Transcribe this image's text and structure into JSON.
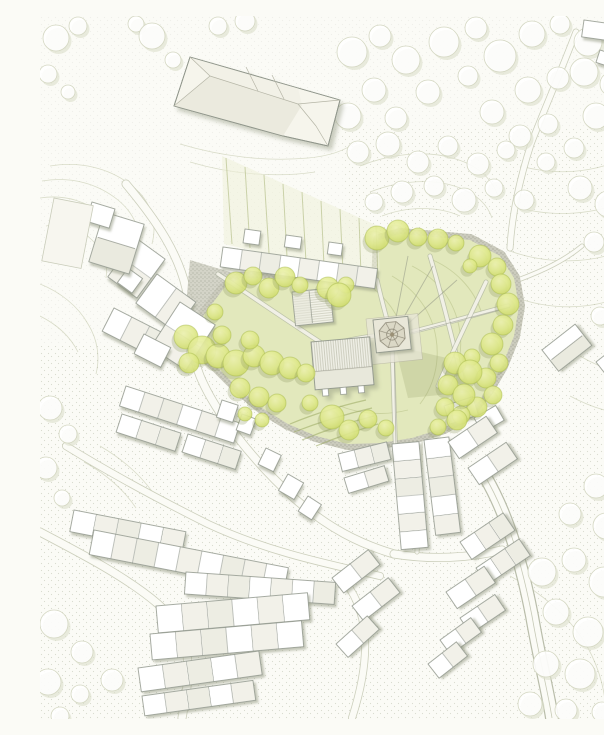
{
  "figure": {
    "kind": "architectural-site-plan",
    "width": 604,
    "height": 703
  },
  "palette": {
    "background": "#fbfbf6",
    "contour": "#b7bd9b",
    "lawnLine": "#b2bc80",
    "parkFill": "#e2e8bc",
    "treeGradIn": "#eef3b0",
    "treeGradMid": "#dfe98a",
    "treeGradOut": "#ccd964",
    "treeEdge": "#aabc4e",
    "treeShadow": "#8d9861",
    "faintTreeStroke": "#d4d7c2",
    "faintTreeShadow": "#dcdfcc",
    "buildingFill": "#ffffff",
    "buildingTint": "#efeee3",
    "buildingTint2": "#e9e8dc",
    "buildingStroke": "#90968b",
    "bandBase": "#cbcbbd",
    "dotInk": "#6f7463",
    "grainInk": "#9aa088",
    "streetEdge": "#cccfbc",
    "pathFill": "#f1f0e6",
    "pathEdge": "#aab09e",
    "plaza": "#e8e6d8",
    "roofBase": "#f0f0e7",
    "roofLower": "#e8e8db",
    "spire": "#dbd8c6",
    "spireLine": "#8a8574",
    "wire": "#909483",
    "allotmentLine": "#a9b577",
    "allotmentFill": "#eef0d8",
    "hedge": "#99a75f",
    "hallFaceA": "#f2f1e7",
    "hallFaceB": "#ebeade",
    "hallLine": "#b5b5a6"
  },
  "map": {
    "contours": [
      "M10,150 C40,145 70,152 92,170 C110,184 118,205 112,228",
      "M2,165 C32,160 58,168 78,184 C95,198 102,216 98,236",
      "M0,182 C26,178 48,186 64,200 C80,214 86,230 84,248",
      "M6,210 C24,206 40,212 52,224 C64,236 68,248 66,262",
      "M140,128 C180,140 225,146 268,142 C290,140 306,134 316,126",
      "M150,146 C190,158 235,162 275,156",
      "M320,150 C350,138 385,134 412,142 C436,148 452,162 458,180",
      "M330,176 C360,164 395,162 420,172 C438,179 448,190 452,202",
      "M342,200 C368,190 398,190 420,200",
      "M480,150 C510,158 540,158 570,148 C586,142 598,134 604,128",
      "M472,190 C505,200 540,200 572,190 C588,184 600,176 604,172",
      "M470,235 C500,246 535,248 566,240 C584,234 598,226 604,220",
      "M472,280 C502,292 536,294 566,286 C588,280 600,272 604,266",
      "M540,340 C560,352 580,358 604,358",
      "M530,380 C556,394 580,400 604,398",
      "M470,560 C500,576 530,600 548,632 C560,654 566,678 566,700",
      "M0,268 C20,276 38,290 48,308 C58,324 60,342 56,358",
      "M0,300 C16,308 30,320 38,336",
      "M60,430 C84,444 104,462 118,484",
      "M44,446 C66,458 84,474 96,492"
    ],
    "stipple_zones": [
      "M0,0 L604,0 L604,703 L0,703 Z",
      "M0,330 L250,330 L360,450 L360,703 L0,703 Z",
      "M360,440 L604,410 L604,703 L360,703 Z",
      "M470,110 L604,110 L604,420 L470,420 Z",
      "M300,110 L470,110 L470,230 L310,225 Z"
    ],
    "zone_opacity": [
      0.12,
      0.26,
      0.24,
      0.22,
      0.2
    ],
    "streets": [
      {
        "d": "M86,168 C118,206 138,238 146,272 C152,300 148,330 160,360 C174,394 210,442 254,482 C288,512 320,528 354,538",
        "w": 9
      },
      {
        "d": "M26,430 C78,462 128,488 168,508 C228,536 288,548 340,560",
        "w": 8
      },
      {
        "d": "M0,516 C42,538 88,562 118,588 C156,622 150,658 142,702",
        "w": 9
      },
      {
        "d": "M300,560 C330,592 332,640 312,702",
        "w": 8
      },
      {
        "d": "M446,462 C468,500 482,548 492,600 C500,646 508,676 512,702",
        "w": 14,
        "major": true
      },
      {
        "d": "M536,16 C520,58 504,94 491,128 C480,162 472,198 470,232",
        "w": 7
      },
      {
        "d": "M354,538 C392,544 430,542 462,534",
        "w": 9
      },
      {
        "d": "M380,424 C380,462 379,500 377,536",
        "w": 5
      },
      {
        "d": "M478,264 C505,254 525,244 542,230",
        "w": 5
      }
    ],
    "background_trees": [
      [
        16,
        22,
        13
      ],
      [
        38,
        10,
        9
      ],
      [
        8,
        58,
        9
      ],
      [
        28,
        76,
        7
      ],
      [
        96,
        8,
        8
      ],
      [
        112,
        20,
        13
      ],
      [
        133,
        44,
        8
      ],
      [
        178,
        10,
        9
      ],
      [
        205,
        5,
        10
      ],
      [
        312,
        36,
        15
      ],
      [
        340,
        20,
        11
      ],
      [
        366,
        44,
        14
      ],
      [
        334,
        74,
        12
      ],
      [
        308,
        100,
        13
      ],
      [
        356,
        102,
        11
      ],
      [
        388,
        76,
        12
      ],
      [
        404,
        26,
        15
      ],
      [
        436,
        12,
        11
      ],
      [
        460,
        40,
        16
      ],
      [
        492,
        18,
        13
      ],
      [
        520,
        8,
        10
      ],
      [
        548,
        26,
        14
      ],
      [
        578,
        12,
        11
      ],
      [
        600,
        34,
        10
      ],
      [
        488,
        74,
        13
      ],
      [
        518,
        62,
        11
      ],
      [
        544,
        56,
        14
      ],
      [
        572,
        68,
        12
      ],
      [
        598,
        84,
        10
      ],
      [
        428,
        60,
        10
      ],
      [
        452,
        96,
        12
      ],
      [
        480,
        120,
        11
      ],
      [
        508,
        108,
        10
      ],
      [
        556,
        100,
        13
      ],
      [
        584,
        118,
        11
      ],
      [
        534,
        132,
        10
      ],
      [
        506,
        146,
        9
      ],
      [
        318,
        136,
        11
      ],
      [
        348,
        128,
        12
      ],
      [
        378,
        146,
        11
      ],
      [
        408,
        130,
        10
      ],
      [
        438,
        148,
        11
      ],
      [
        466,
        134,
        9
      ],
      [
        362,
        176,
        11
      ],
      [
        394,
        170,
        10
      ],
      [
        424,
        184,
        12
      ],
      [
        454,
        172,
        9
      ],
      [
        484,
        184,
        10
      ],
      [
        334,
        186,
        9
      ],
      [
        540,
        172,
        12
      ],
      [
        568,
        188,
        13
      ],
      [
        596,
        206,
        11
      ],
      [
        554,
        226,
        10
      ],
      [
        584,
        246,
        12
      ],
      [
        602,
        290,
        10
      ],
      [
        560,
        300,
        9
      ],
      [
        596,
        336,
        10
      ],
      [
        580,
        372,
        11
      ],
      [
        604,
        396,
        9
      ],
      [
        556,
        470,
        12
      ],
      [
        586,
        458,
        10
      ],
      [
        530,
        498,
        11
      ],
      [
        566,
        510,
        13
      ],
      [
        598,
        498,
        10
      ],
      [
        502,
        556,
        14
      ],
      [
        534,
        544,
        12
      ],
      [
        564,
        566,
        15
      ],
      [
        596,
        552,
        11
      ],
      [
        516,
        596,
        13
      ],
      [
        548,
        616,
        15
      ],
      [
        582,
        606,
        12
      ],
      [
        506,
        648,
        13
      ],
      [
        540,
        658,
        15
      ],
      [
        576,
        668,
        12
      ],
      [
        602,
        638,
        10
      ],
      [
        490,
        688,
        12
      ],
      [
        526,
        694,
        11
      ],
      [
        562,
        696,
        10
      ],
      [
        10,
        392,
        12
      ],
      [
        28,
        418,
        9
      ],
      [
        6,
        452,
        11
      ],
      [
        22,
        482,
        8
      ],
      [
        14,
        608,
        14
      ],
      [
        42,
        636,
        11
      ],
      [
        8,
        666,
        13
      ],
      [
        40,
        678,
        9
      ],
      [
        72,
        664,
        11
      ],
      [
        20,
        700,
        9
      ]
    ],
    "park_outline": "M150,320 L166,296 L184,272 L200,262 L337,266 L339,224 L360,218 L430,224 L460,240 L474,262 L479,290 L474,320 L462,350 L448,374 L430,396 L404,412 L372,422 L340,427 L308,428 L276,420 L248,408 L222,392 L198,372 L176,350 L158,334 Z",
    "west_plaza": "M150,244 L210,262 L190,330 L156,340 L146,290 Z",
    "lawn_arcs": [
      "M372,250 C396,262 412,282 418,306 C424,330 420,356 406,376",
      "M352,260 C376,274 392,296 396,322 C400,346 394,370 380,388",
      "M388,242 C414,252 434,272 442,298",
      "M330,270 C352,286 364,308 366,334",
      "M300,390 C320,398 344,400 368,394"
    ],
    "shadow_blob": "M355,330 L420,345 L432,376 L368,382 Z",
    "allotment_area": "M182,140 L338,210 L340,264 L184,228 Z",
    "allotment_lines": [
      [
        186,
        142,
        192,
        228
      ],
      [
        205,
        151,
        210,
        232
      ],
      [
        224,
        159,
        229,
        237
      ],
      [
        243,
        168,
        247,
        241
      ],
      [
        262,
        176,
        266,
        246
      ],
      [
        281,
        185,
        284,
        250
      ],
      [
        300,
        193,
        303,
        255
      ],
      [
        319,
        202,
        321,
        259
      ],
      [
        336,
        210,
        338,
        262
      ]
    ],
    "hedges": [
      "M250,408 C274,398 300,390 326,384",
      "M254,416 C280,406 306,398 332,392",
      "M262,424 C286,414 310,406 334,400",
      "M276,430 C298,421 318,414 338,408"
    ],
    "park_paths": [
      "M178,258 C214,282 252,308 286,330",
      "M337,264 C342,286 347,304 351,318",
      "M352,326 C353,360 354,396 356,448",
      "M354,320 C390,312 430,300 468,290",
      "M286,330 C300,326 316,322 334,320",
      "M390,240 C402,280 412,322 422,362",
      "M446,266 C430,300 412,336 398,370"
    ],
    "sightlines": [
      "M352,322 L368,240",
      "M352,322 L393,250",
      "M352,322 L417,264",
      "M352,322 L470,291",
      "M354,326 L356,430"
    ],
    "terraces": [
      [
        183,
        231,
        156,
        20,
        8,
        8,
        "n"
      ],
      [
        205,
        213,
        16,
        14,
        8,
        1,
        "n"
      ],
      [
        246,
        219,
        16,
        12,
        8,
        1,
        "n"
      ],
      [
        289,
        226,
        14,
        12,
        8,
        1,
        "n"
      ],
      [
        96,
        222,
        36,
        48,
        36,
        2,
        "n"
      ],
      [
        117,
        258,
        48,
        36,
        36,
        2,
        "n"
      ],
      [
        74,
        292,
        60,
        26,
        27,
        3,
        "n"
      ],
      [
        140,
        286,
        42,
        54,
        33,
        2,
        "n"
      ],
      [
        104,
        318,
        30,
        22,
        27,
        1,
        "n"
      ],
      [
        88,
        252,
        18,
        18,
        36,
        1,
        "n"
      ],
      [
        64,
        196,
        42,
        52,
        17,
        1,
        "r"
      ],
      [
        52,
        186,
        24,
        20,
        17,
        1,
        "n"
      ],
      [
        14,
        182,
        40,
        64,
        11,
        1,
        "f"
      ],
      [
        86,
        370,
        120,
        21,
        18,
        6,
        "n"
      ],
      [
        82,
        398,
        62,
        19,
        18,
        3,
        "n"
      ],
      [
        148,
        418,
        56,
        19,
        18,
        3,
        "n"
      ],
      [
        182,
        384,
        17,
        18,
        18,
        1,
        "n"
      ],
      [
        202,
        398,
        15,
        17,
        20,
        1,
        "n"
      ],
      [
        226,
        432,
        17,
        18,
        26,
        1,
        "n"
      ],
      [
        248,
        458,
        18,
        19,
        30,
        1,
        "n"
      ],
      [
        268,
        480,
        16,
        18,
        33,
        1,
        "n"
      ],
      [
        34,
        494,
        114,
        22,
        11,
        5,
        "n"
      ],
      [
        54,
        514,
        198,
        25,
        11,
        9,
        "n"
      ],
      [
        146,
        556,
        150,
        22,
        4,
        7,
        "n"
      ],
      [
        116,
        590,
        152,
        27,
        -5,
        6,
        "n"
      ],
      [
        110,
        618,
        152,
        26,
        -5,
        6,
        "n"
      ],
      [
        98,
        652,
        122,
        24,
        -8,
        5,
        "n"
      ],
      [
        102,
        680,
        112,
        20,
        -8,
        5,
        "n"
      ],
      [
        292,
        562,
        46,
        19,
        -38,
        2,
        "n"
      ],
      [
        312,
        590,
        46,
        19,
        -38,
        2,
        "n"
      ],
      [
        296,
        628,
        42,
        18,
        -42,
        2,
        "n"
      ],
      [
        352,
        428,
        27,
        106,
        -5,
        6,
        "n"
      ],
      [
        384,
        424,
        25,
        96,
        -7,
        5,
        "n"
      ],
      [
        298,
        438,
        50,
        18,
        -14,
        3,
        "n"
      ],
      [
        304,
        462,
        42,
        16,
        -17,
        2,
        "n"
      ],
      [
        404,
        390,
        30,
        19,
        -18,
        2,
        "n"
      ],
      [
        434,
        402,
        25,
        17,
        -30,
        1,
        "n"
      ],
      [
        408,
        426,
        46,
        20,
        -34,
        2,
        "n"
      ],
      [
        428,
        452,
        46,
        20,
        -34,
        2,
        "n"
      ],
      [
        420,
        526,
        52,
        21,
        -34,
        3,
        "n"
      ],
      [
        436,
        552,
        52,
        20,
        -34,
        3,
        "n"
      ],
      [
        406,
        576,
        46,
        20,
        -34,
        2,
        "n"
      ],
      [
        420,
        602,
        42,
        19,
        -34,
        2,
        "n"
      ],
      [
        400,
        624,
        38,
        18,
        -36,
        2,
        "n"
      ],
      [
        388,
        648,
        36,
        18,
        -38,
        2,
        "n"
      ],
      [
        502,
        334,
        42,
        27,
        -38,
        1,
        "r"
      ],
      [
        556,
        346,
        36,
        23,
        -38,
        1,
        "r"
      ],
      [
        544,
        4,
        28,
        17,
        8,
        1,
        "n"
      ],
      [
        574,
        12,
        24,
        15,
        -4,
        1,
        "n"
      ],
      [
        560,
        34,
        20,
        13,
        18,
        1,
        "n"
      ],
      [
        574,
        30,
        28,
        25,
        -42,
        1,
        "r"
      ]
    ],
    "hall": {
      "outline": "M150,41 L258,72 L300,84 L288,130 L243,120 L134,90 Z",
      "faceA": "150,41 258,72 262,89 170,60",
      "faceB": "170,60 262,89 243,120 134,90",
      "ridges": [
        "M170,60 L258,88",
        "M150,41 L170,60",
        "M134,90 L170,60",
        "M258,88 L300,84",
        "M258,88 L276,110",
        "M276,110 L288,130",
        "M206,51 L218,75",
        "M232,59 L244,83"
      ]
    },
    "church": {
      "x": 271,
      "y": 326,
      "w": 59,
      "h": 48,
      "rot": -5,
      "roofSplit": 0.62,
      "buttresses": [
        7,
        25,
        43
      ]
    },
    "outbuilding": {
      "x": 252,
      "y": 276,
      "w": 38,
      "h": 34,
      "rot": -6,
      "ridgeAt": 0.45
    },
    "plaza": {
      "x": 326,
      "y": 303,
      "w": 52,
      "h": 46,
      "rot": -6
    },
    "tower": {
      "x": 333,
      "y": 304,
      "w": 35,
      "h": 33,
      "rot": -6,
      "spireR": 13.5,
      "innerR": 5.5,
      "hubR": 2.2
    },
    "park_trees": [
      [
        196,
        267,
        11
      ],
      [
        213,
        260,
        9
      ],
      [
        229,
        272,
        10
      ],
      [
        245,
        261,
        10
      ],
      [
        260,
        269,
        8
      ],
      [
        288,
        272,
        11
      ],
      [
        306,
        269,
        8
      ],
      [
        299,
        279,
        12
      ],
      [
        175,
        296,
        8
      ],
      [
        337,
        222,
        12
      ],
      [
        358,
        215,
        11
      ],
      [
        378,
        221,
        9
      ],
      [
        398,
        223,
        10
      ],
      [
        416,
        227,
        8
      ],
      [
        440,
        240,
        11
      ],
      [
        457,
        251,
        9
      ],
      [
        430,
        250,
        7
      ],
      [
        461,
        268,
        10
      ],
      [
        468,
        288,
        11
      ],
      [
        463,
        309,
        10
      ],
      [
        452,
        328,
        11
      ],
      [
        459,
        347,
        9
      ],
      [
        446,
        362,
        10
      ],
      [
        453,
        379,
        9
      ],
      [
        437,
        391,
        10
      ],
      [
        421,
        399,
        9
      ],
      [
        432,
        341,
        8
      ],
      [
        415,
        347,
        11
      ],
      [
        430,
        356,
        12
      ],
      [
        408,
        369,
        10
      ],
      [
        424,
        379,
        11
      ],
      [
        405,
        391,
        9
      ],
      [
        417,
        404,
        10
      ],
      [
        398,
        411,
        8
      ],
      [
        292,
        401,
        12
      ],
      [
        309,
        414,
        10
      ],
      [
        328,
        403,
        9
      ],
      [
        346,
        412,
        8
      ],
      [
        270,
        387,
        8
      ],
      [
        146,
        321,
        12
      ],
      [
        162,
        334,
        14
      ],
      [
        149,
        347,
        10
      ],
      [
        178,
        340,
        12
      ],
      [
        196,
        347,
        13
      ],
      [
        214,
        340,
        11
      ],
      [
        232,
        347,
        12
      ],
      [
        250,
        352,
        11
      ],
      [
        266,
        357,
        9
      ],
      [
        182,
        319,
        9
      ],
      [
        210,
        324,
        9
      ],
      [
        200,
        372,
        10
      ],
      [
        219,
        381,
        10
      ],
      [
        237,
        387,
        9
      ],
      [
        205,
        398,
        7
      ],
      [
        222,
        404,
        7
      ]
    ]
  }
}
